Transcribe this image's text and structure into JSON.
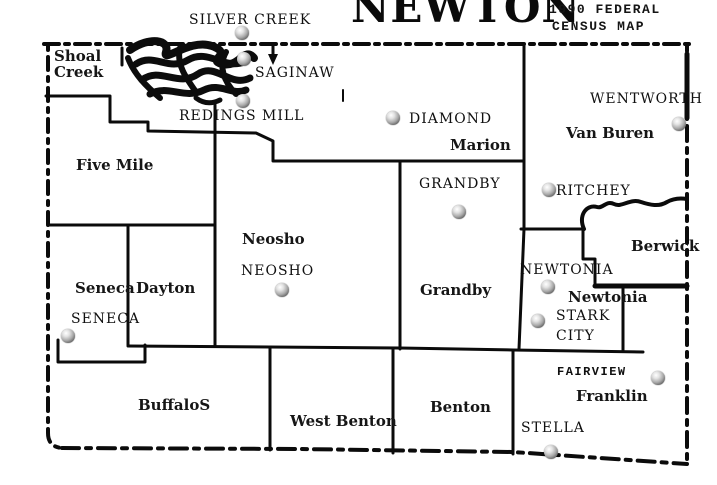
{
  "header": {
    "title": "NEWTON",
    "subtitle_line1": "1990 FEDERAL",
    "subtitle_line2": "CENSUS MAP"
  },
  "map": {
    "colors": {
      "ink": "#0b0b0b",
      "paper": "#ffffff",
      "marker_gray": "#a9a9a9"
    },
    "townships": [
      {
        "id": "shoal-creek",
        "label": "Shoal\nCreek",
        "x": 54,
        "y": 48
      },
      {
        "id": "five-mile",
        "label": "Five Mile",
        "x": 76,
        "y": 157
      },
      {
        "id": "seneca",
        "label": "Seneca",
        "x": 75,
        "y": 280
      },
      {
        "id": "dayton",
        "label": "Dayton",
        "x": 136,
        "y": 280
      },
      {
        "id": "neosho",
        "label": "Neosho",
        "x": 242,
        "y": 231
      },
      {
        "id": "marion",
        "label": "Marion",
        "x": 450,
        "y": 137
      },
      {
        "id": "van-buren",
        "label": "Van Buren",
        "x": 566,
        "y": 125
      },
      {
        "id": "grandby",
        "label": "Grandby",
        "x": 420,
        "y": 282
      },
      {
        "id": "newtonia",
        "label": "Newtonia",
        "x": 568,
        "y": 289
      },
      {
        "id": "berwick",
        "label": "Berwick",
        "x": 631,
        "y": 238
      },
      {
        "id": "buffalos",
        "label": "BuffaloS",
        "x": 138,
        "y": 397
      },
      {
        "id": "west-benton",
        "label": "West Benton",
        "x": 290,
        "y": 413
      },
      {
        "id": "benton",
        "label": "Benton",
        "x": 430,
        "y": 399
      },
      {
        "id": "franklin",
        "label": "Franklin",
        "x": 576,
        "y": 388
      }
    ],
    "towns": [
      {
        "id": "silver-creek",
        "label": "SILVER CREEK",
        "label_x": 189,
        "label_y": 10,
        "marker_x": 242,
        "marker_y": 33,
        "mono": false
      },
      {
        "id": "saginaw",
        "label": "SAGINAW",
        "label_x": 255,
        "label_y": 63,
        "marker_x": 244,
        "marker_y": 59,
        "mono": false
      },
      {
        "id": "redings-mill",
        "label": "REDINGS MILL",
        "label_x": 179,
        "label_y": 106,
        "marker_x": 243,
        "marker_y": 101,
        "mono": false
      },
      {
        "id": "diamond",
        "label": "DIAMOND",
        "label_x": 409,
        "label_y": 109,
        "marker_x": 393,
        "marker_y": 118,
        "mono": false
      },
      {
        "id": "wentworth",
        "label": "WENTWORTH",
        "label_x": 590,
        "label_y": 89,
        "marker_x": 679,
        "marker_y": 124,
        "mono": false
      },
      {
        "id": "ritchey",
        "label": "RITCHEY",
        "label_x": 556,
        "label_y": 181,
        "marker_x": 549,
        "marker_y": 190,
        "mono": false
      },
      {
        "id": "grandby-town",
        "label": "GRANDBY",
        "label_x": 419,
        "label_y": 174,
        "marker_x": 459,
        "marker_y": 212,
        "mono": false
      },
      {
        "id": "neosho-town",
        "label": "NEOSHO",
        "label_x": 241,
        "label_y": 261,
        "marker_x": 282,
        "marker_y": 290,
        "mono": false
      },
      {
        "id": "newtonia-town",
        "label": "NEWTONIA",
        "label_x": 520,
        "label_y": 260,
        "marker_x": 548,
        "marker_y": 287,
        "mono": false
      },
      {
        "id": "seneca-town",
        "label": "SENECA",
        "label_x": 71,
        "label_y": 309,
        "marker_x": 68,
        "marker_y": 336,
        "mono": false
      },
      {
        "id": "stark-city",
        "label": "STARK\nCITY",
        "label_x": 556,
        "label_y": 306,
        "marker_x": 538,
        "marker_y": 321,
        "mono": false
      },
      {
        "id": "fairview",
        "label": "FAIRVIEW",
        "label_x": 557,
        "label_y": 365,
        "marker_x": 658,
        "marker_y": 378,
        "mono": true
      },
      {
        "id": "stella",
        "label": "STELLA",
        "label_x": 521,
        "label_y": 418,
        "marker_x": 551,
        "marker_y": 452,
        "mono": false
      }
    ]
  }
}
